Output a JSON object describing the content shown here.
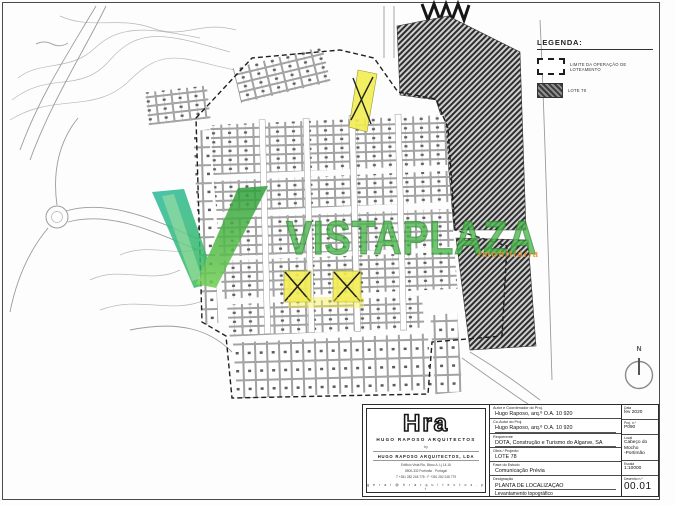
{
  "watermark": {
    "brand": "VISTAPLAZA",
    "subtext": "imobiliária",
    "green": "#49b649",
    "teal": "#28b99e",
    "orange": "#e8912c"
  },
  "legend": {
    "title": "LEGENDA:",
    "items": [
      {
        "swatch": "dashed-outline",
        "label": "LIMITE DA OPERAÇÃO DE LOTEAMENTO"
      },
      {
        "swatch": "hatched-fill",
        "label": "LOTE 78"
      }
    ]
  },
  "north_label": "N",
  "plan": {
    "highlight_color": "#f3ee52",
    "hatch_color": "#2e2e2e",
    "highlighted_lots_marked": 3
  },
  "titleblock": {
    "logo": {
      "monogram": "Hra",
      "firm": "HUGO RAPOSO ARQUITECTOS",
      "by": "by",
      "company": "HUGO RAPOSO ARQUITECTOS, LDA",
      "address1": "Edifício Vista Rio, Bloco A, Lj 14-16",
      "address2": "8500-332 Portimão   ·   Portugal",
      "phones": "T +351 282 248 778   ·   F +351 282 248 779",
      "email": "g e r a l @ h r a r q u i t e c t o s . p t"
    },
    "fields": [
      {
        "label": "Autor e Coordenador do Proj.",
        "value": "Hugo Raposo, arq.º O.A. 10 920"
      },
      {
        "label": "Co-Autor do Proj.",
        "value": "Hugo Raposo, arq.º O.A. 10 920"
      },
      {
        "label": "Requerente",
        "value": "DOTA, Construção e Turismo do Algarve, SA"
      },
      {
        "label": "Obra / Projecto",
        "value": "LOTE 78"
      },
      {
        "label": "Fase do Estudo",
        "value": "Comunicação Prévia"
      },
      {
        "label": "Designação",
        "value": "PLANTA DE LOCALIZAÇÃO",
        "value2": "Levantamento topográfico"
      }
    ],
    "meta": [
      {
        "label": "Data",
        "value": "fev 2020"
      },
      {
        "label": "Proj. n.º",
        "value": "P090"
      },
      {
        "label": "Local",
        "value": "Cabeço do Mocho",
        "value2": "-Portimão"
      },
      {
        "label": "Escala",
        "value": "1:10000"
      },
      {
        "label": "Desenho n.º",
        "value": "00.01",
        "big": true
      }
    ]
  }
}
